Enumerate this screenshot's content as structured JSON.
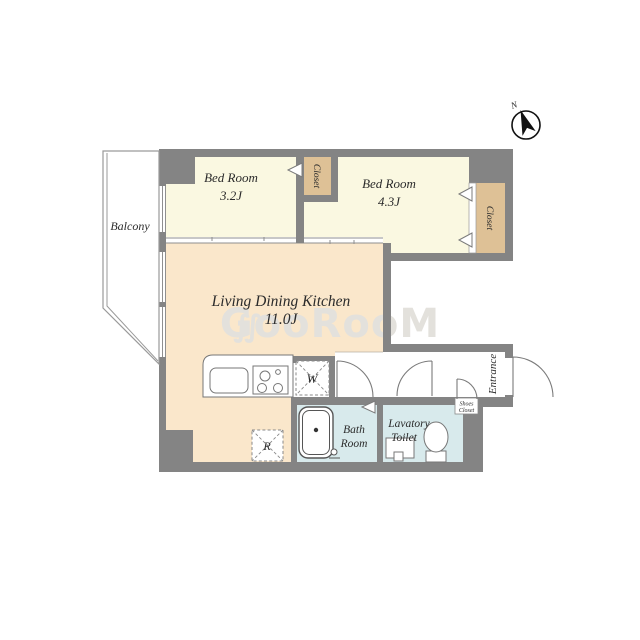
{
  "colors": {
    "wall": "#848484",
    "bedroom": "#faf8e1",
    "ldk": "#fae7cb",
    "closet": "#dec196",
    "wet": "#d8eaec",
    "text": "#2b2b2b",
    "watermark": "#e3e1dc"
  },
  "compass": {
    "label": "N"
  },
  "watermark": {
    "logo": "∬",
    "text": "GooRooM"
  },
  "balcony": {
    "label": "Balcony"
  },
  "bedroom1": {
    "name": "Bed Room",
    "size": "3.2J",
    "closet": "Closet"
  },
  "bedroom2": {
    "name": "Bed Room",
    "size": "4.3J",
    "closet": "Closet"
  },
  "ldk": {
    "name": "Living Dining Kitchen",
    "size": "11.0J"
  },
  "bath": {
    "line1": "Bath",
    "line2": "Room"
  },
  "lavatory": {
    "line1": "Lavatory",
    "line2": "Toilet"
  },
  "entrance": {
    "label": "Entrance"
  },
  "shoes_closet": {
    "line1": "Shoes",
    "line2": "Closet"
  },
  "washer": {
    "label": "W"
  },
  "fridge": {
    "label": "R"
  }
}
